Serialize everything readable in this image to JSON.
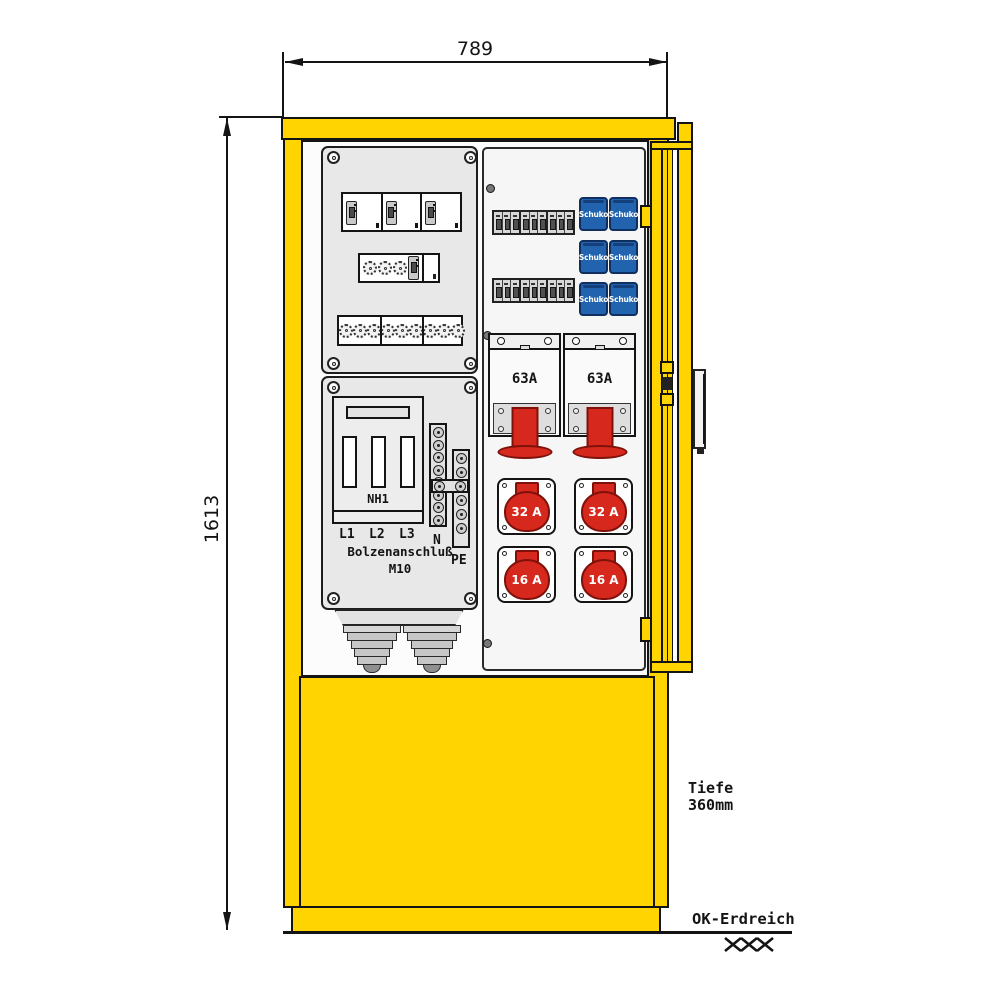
{
  "colors": {
    "yellow": "#FFD400",
    "outline": "#141414",
    "panel_gray": "#e8e8e8",
    "panel_light": "#f6f6f6",
    "schuko_blue": "#2163ae",
    "schuko_blue_dark": "#102e5e",
    "cee_red": "#d6281c",
    "cee_red_dark": "#7e120b"
  },
  "dimensions": {
    "width": "789",
    "height": "1613",
    "depth_line1": "Tiefe",
    "depth_line2": "360mm",
    "ground": "OK-Erdreich"
  },
  "left_panel": {
    "nh_fuse": "NH1",
    "phases": [
      "L1",
      "L2",
      "L3"
    ],
    "connection": "Bolzenanschluß",
    "bolt": "M10",
    "neutral": "N",
    "earth": "PE"
  },
  "right_panel": {
    "schuko_label": "Schuko",
    "cee63": [
      {
        "label": "63A"
      },
      {
        "label": "63A"
      }
    ],
    "cee": [
      {
        "label": "32 A"
      },
      {
        "label": "32 A"
      },
      {
        "label": "16 A"
      },
      {
        "label": "16 A"
      }
    ]
  }
}
